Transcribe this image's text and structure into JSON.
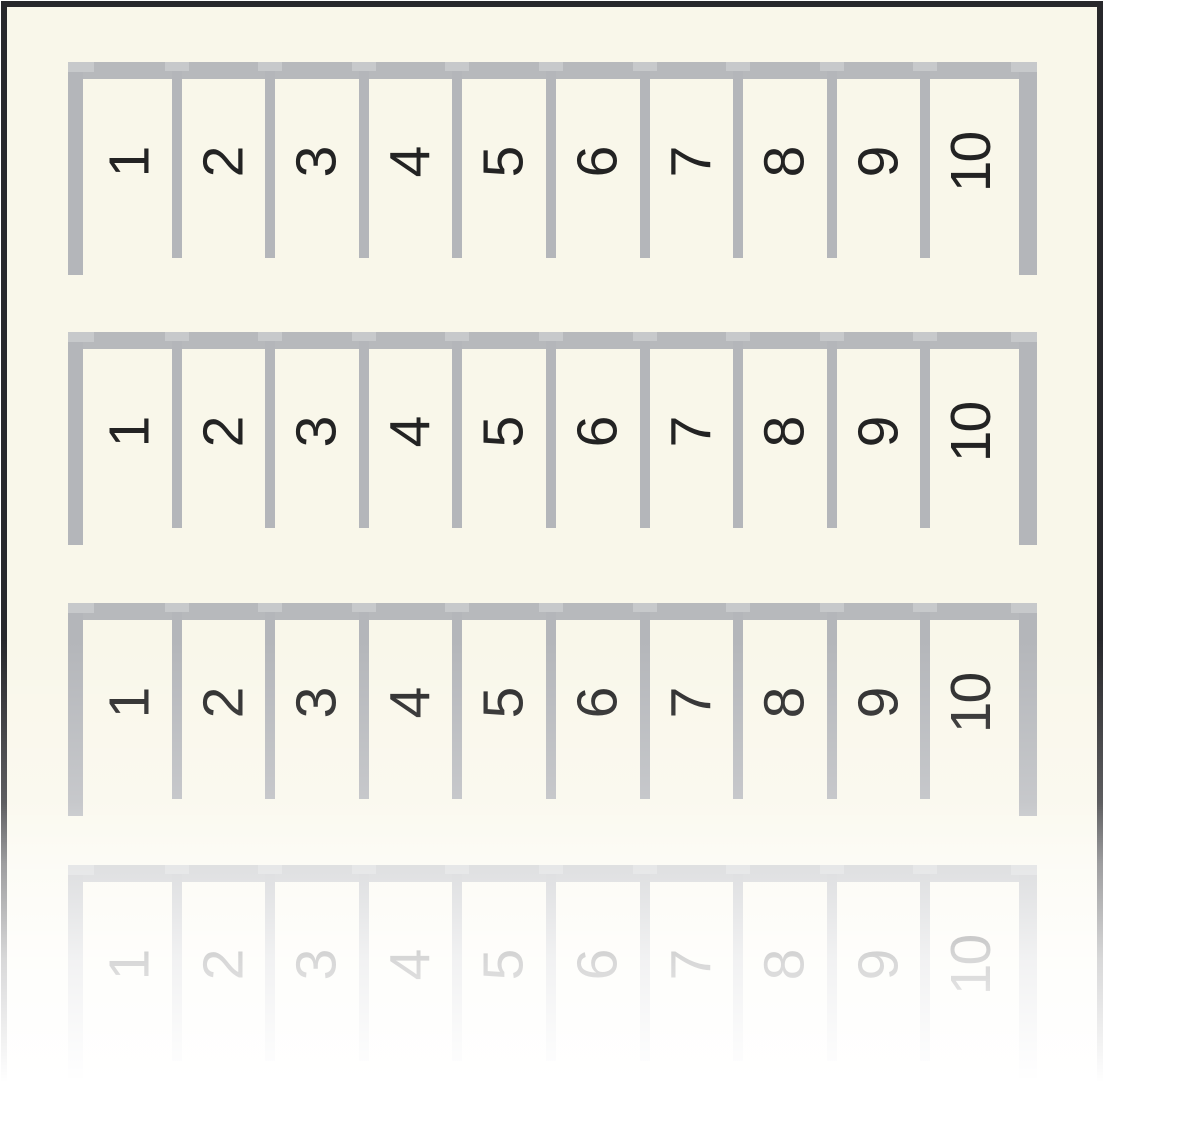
{
  "product_image": {
    "description_visible_content": "four horizontal marker strips, each divided into 10 labeled cells",
    "strips": [
      {
        "name": "marker-strip-1",
        "labels": [
          "1",
          "2",
          "3",
          "4",
          "5",
          "6",
          "7",
          "8",
          "9",
          "10"
        ]
      },
      {
        "name": "marker-strip-2",
        "labels": [
          "1",
          "2",
          "3",
          "4",
          "5",
          "6",
          "7",
          "8",
          "9",
          "10"
        ]
      },
      {
        "name": "marker-strip-3",
        "labels": [
          "1",
          "2",
          "3",
          "4",
          "5",
          "6",
          "7",
          "8",
          "9",
          "10"
        ]
      },
      {
        "name": "marker-strip-4-faded",
        "labels": [
          "1",
          "2",
          "3",
          "4",
          "5",
          "6",
          "7",
          "8",
          "9",
          "10"
        ]
      }
    ]
  },
  "colors": {
    "canvas_white": "#ffffff",
    "card_background_cream": "#f9f7ea",
    "card_border_black": "#28282b",
    "rail_gray": "#b4b6ba",
    "rail_bottom_gray": "#b7b9bc",
    "cap_light_gray": "#c7c9cb",
    "number_black": "#232323"
  }
}
